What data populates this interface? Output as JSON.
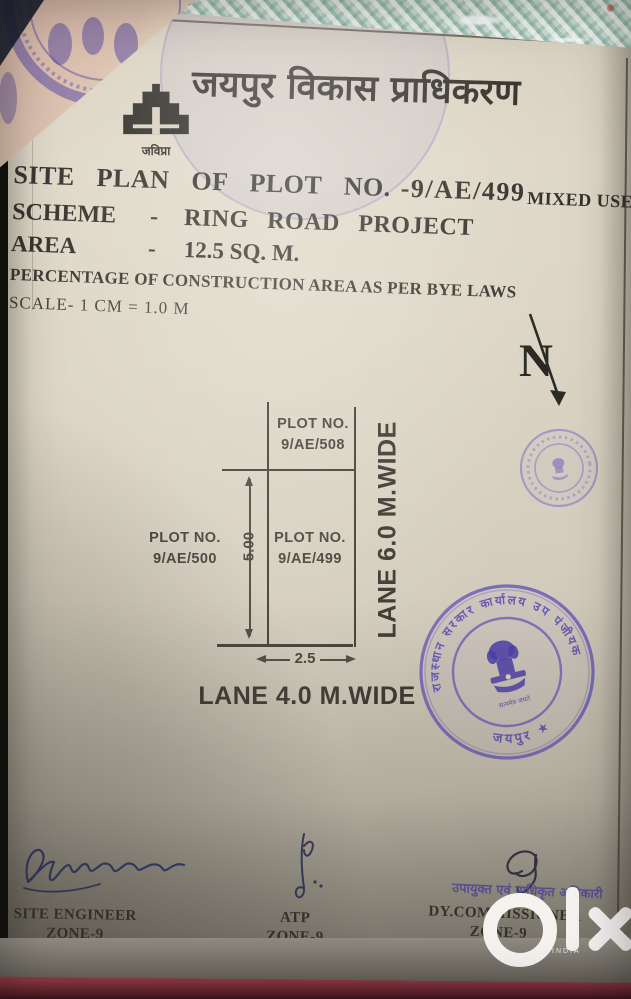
{
  "authority_header": {
    "name_hi": "जयपुर विकास प्राधिकरण",
    "logo_caption_hi": "जविप्रा"
  },
  "title_block": {
    "line1_main": "SITE PLAN OF PLOT NO.",
    "line1_plot_no": "-9/AE/499",
    "line1_suffix": "MIXED USE)",
    "scheme_label": "SCHEME",
    "scheme_dash": "-",
    "scheme_value": "RING ROAD PROJECT",
    "area_label": "AREA",
    "area_dash": "-",
    "area_value": "12.5 SQ. M.",
    "byelaw_line": "PERCENTAGE OF CONSTRUCTION AREA AS PER BYE LAWS",
    "scale_line": "SCALE- 1 CM = 1.0 M"
  },
  "compass": {
    "letter": "N"
  },
  "site_plan": {
    "plot_top": {
      "line1": "PLOT NO.",
      "line2": "9/AE/508"
    },
    "plot_center": {
      "line1": "PLOT NO.",
      "line2": "9/AE/499"
    },
    "plot_left": {
      "line1": "PLOT NO.",
      "line2": "9/AE/500"
    },
    "dim_vertical": "5.00",
    "dim_horizontal": "2.5",
    "lane_right": "LANE 6.0 M.WIDE",
    "lane_bottom": "LANE 4.0 M.WIDE"
  },
  "stamps": {
    "large_round": {
      "ring_text_hi": "राजस्थान सरकार कार्यालय उप पंजीयक",
      "bottom_text_hi": "जयपुर ★",
      "emblem_caption_hi": "सत्यमेव जयते",
      "color": "#5c50b8"
    },
    "authorized_officer_text_hi": "उपायुक्त एवं प्राधिकृत अधिकारी",
    "authorized_officer_text2_hi": "जयपुर"
  },
  "signature_block": {
    "left": {
      "line1": "SITE ENGINEER",
      "line2": "ZONE-9"
    },
    "center": {
      "line1": "ATP",
      "line2": "ZONE-9"
    },
    "right": {
      "line1": "DY.COMMISSIONER",
      "line2": "ZONE-9"
    }
  },
  "watermark": {
    "brand": "olx",
    "sub": "INDIA"
  },
  "colors": {
    "paper": "#d9d2c2",
    "ink": "#34322c",
    "stamp_purple": "#5c50b8",
    "signature_blue": "#2c3a85",
    "teal_doc": "#bed7c9",
    "red_band": "#8c3742"
  }
}
